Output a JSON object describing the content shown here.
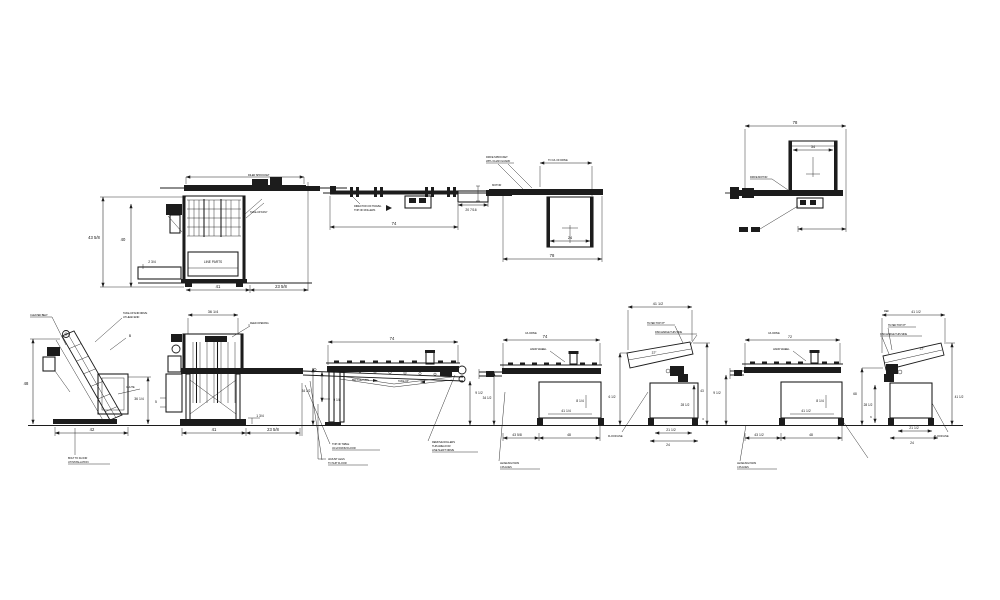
{
  "drawing": {
    "background": "#ffffff",
    "ink": "#1c1c1c",
    "description": "equipment line layout - elevation and plan views"
  },
  "views": {
    "hopper_upper": {
      "dims": {
        "height": "43 5/8",
        "inner_height": "40",
        "step": "2 3/4",
        "base": "41",
        "overhang": "23 5/8"
      },
      "labels": {
        "panel": "LINE PARTS"
      },
      "notes": {
        "sprocket": "IDLER SPROCKET",
        "takeup": "TAKE-UP ASSY"
      }
    },
    "conveyor_plan": {
      "dims": {
        "length": "74",
        "width": "20 7/16"
      },
      "notes": {
        "travel": "DIRECTION OF TRAVEL",
        "rollers": "TOP OF ROLLERS"
      }
    },
    "conveyor_side": {
      "dims": {
        "length": "78",
        "box": "24"
      },
      "notes": {
        "n1": "DRIVE SPROCKET",
        "n2": "WITH CHAIN GUARD",
        "motor": "MOTOR",
        "cl": "TO C/L OF DRIVE"
      }
    },
    "end_view": {
      "dims": {
        "length": "78",
        "box": "34"
      },
      "notes": {
        "motor": "DRIVE MOTOR"
      }
    },
    "incline": {
      "dims": {
        "height": "48",
        "base": "42",
        "chute_height": "36 1/4"
      },
      "notes": {
        "belt": "CLEATED BELT",
        "drive1": "TAKE-UP AND DRIVE",
        "drive2": "AT HEAD END",
        "b": "B",
        "chute": "CHUTE",
        "foot1": "BOLT TO FLOOR",
        "foot2": "AT INSTALLATION"
      }
    },
    "hopper_lower": {
      "dims": {
        "top": "36 1/4",
        "base": "41",
        "overhang": "23 5/8",
        "step": "1 3/4",
        "belt_height": "9 1/2",
        "left": "5"
      },
      "notes": {
        "opening": "FEED OPENING",
        "below1a": "TOP OF TABLE",
        "below1b": "34 1/2 FROM FLOOR",
        "below2a": "ADJUST LEGS",
        "below2b": "TO SUIT FLOOR"
      }
    },
    "table_side": {
      "dims": {
        "length": "74",
        "belt": "9 1/8",
        "height": "34 1/2"
      },
      "notes": {
        "return": "BELT RETURN",
        "takeup": "TAKE-UP",
        "below1": "REMOVE ROLLERS",
        "below2": "THIS AREA FOR",
        "below3": "LINE SHAFT DRIVE"
      }
    },
    "box_table_1": {
      "dims": {
        "length": "74",
        "cl": "C/L DRIVE",
        "d1": "8 1/4",
        "d2": "41 1/4",
        "height": "34 1/2",
        "b1": "43 5/8",
        "b2": "48"
      },
      "notes": {
        "wheel": "HAND WHEEL",
        "pads1": "LEVELING PADS",
        "pads2": "4 PLACES"
      }
    },
    "tilt_table_1": {
      "dims": {
        "top": "41 1/2",
        "angle": "37°",
        "left": "6 1/2",
        "right": "43",
        "inner": "28 1/2",
        "small": "3",
        "b1": "21 1/2",
        "b2": "24"
      },
      "notes": {
        "n1": "TILTED TOP 37°",
        "n2": "DISCHARGE THIS SIDE",
        "floor": "FLOOR LINE"
      }
    },
    "box_table_2": {
      "dims": {
        "length": "72",
        "cl": "C/L DRIVE",
        "d1": "8 1/4",
        "d2": "41 1/2",
        "left": "9 1/2",
        "b1": "43 1/2",
        "b2": "48"
      },
      "notes": {
        "wheel": "HAND WHEEL",
        "pads1": "LEVELING PADS",
        "pads2": "4 PLACES"
      }
    },
    "tilt_table_2": {
      "dims": {
        "top": "41 1/2",
        "ref": "REF",
        "angle": "37°",
        "left": "68",
        "right": "41 1/2",
        "inner": "28 1/2",
        "small": "6",
        "b1": "21 1/2",
        "b2": "24"
      },
      "notes": {
        "n1": "TILTED TOP 37°",
        "n2": "DISCHARGE THIS SIDE",
        "floor": "FLOOR LINE"
      }
    }
  }
}
